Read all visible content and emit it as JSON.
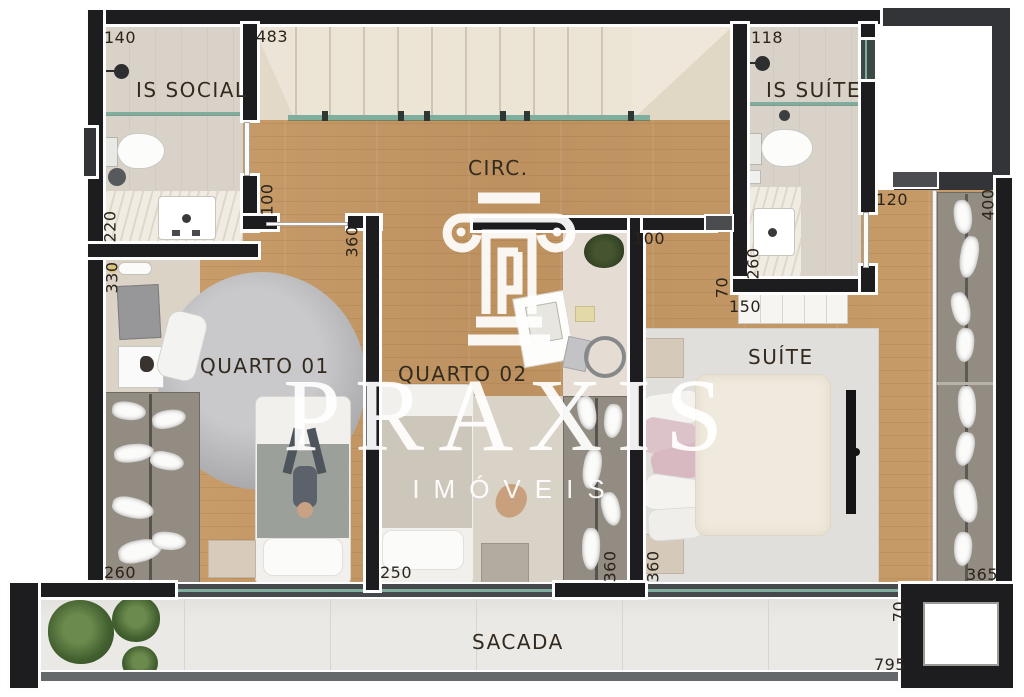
{
  "plan_title": "Floor plan - upper level",
  "watermark": {
    "brand": "PRAXIS",
    "sub": "IMÓVEIS"
  },
  "rooms": {
    "is_social": "IS SOCIAL",
    "circ": "CIRC.",
    "is_suite": "IS SUÍTE",
    "quarto01": "QUARTO 01",
    "quarto02": "QUARTO 02",
    "suite": "SUÍTE",
    "sacada": "SACADA"
  },
  "dims": {
    "d140": "140",
    "d483": "483",
    "d118": "118",
    "d220": "220",
    "d100a": "100",
    "d330": "330",
    "d360a": "360",
    "d100b": "100",
    "d70a": "70",
    "d150": "150",
    "d260a": "260",
    "d120": "120",
    "d400": "400",
    "d260b": "260",
    "d250": "250",
    "d360b": "360",
    "d360c": "360",
    "d365": "365",
    "d70b": "70",
    "d795": "795"
  },
  "colors": {
    "wall": "#1d1d20",
    "wood": "#c59a66",
    "glass": "#7fae9e",
    "rug_gray": "#b0b0b3",
    "suite_rug": "#e1dfdc",
    "label": "#2a241d"
  }
}
